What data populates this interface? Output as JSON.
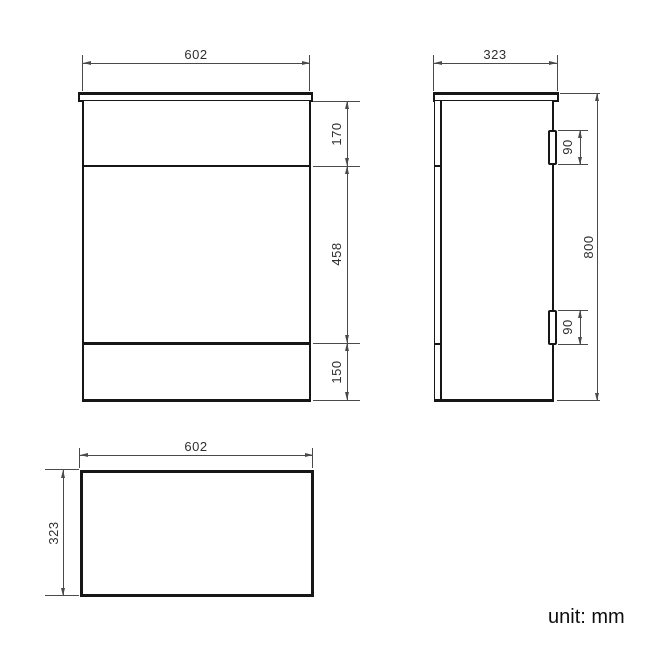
{
  "unit_note": "unit: mm",
  "front_view": {
    "width": "602",
    "top_section_height": "170",
    "middle_section_height": "458",
    "bottom_section_height": "150"
  },
  "side_view": {
    "depth": "323",
    "height": "800",
    "hinge_top_size": "90",
    "hinge_bottom_size": "90"
  },
  "plan_view": {
    "width": "602",
    "depth": "323"
  }
}
